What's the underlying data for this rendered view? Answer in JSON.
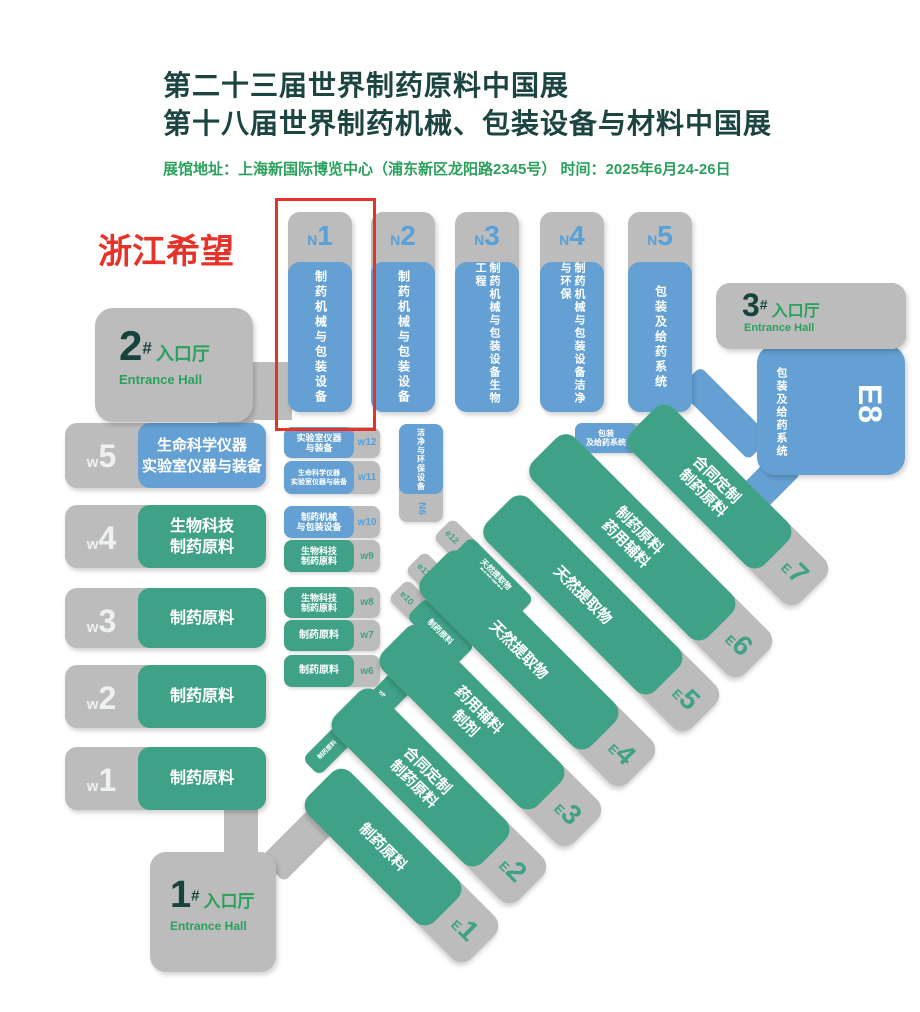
{
  "header": {
    "title_line1": "第二十三届世界制药原料中国展",
    "title_line2": "第十八届世界制药机械、包装设备与材料中国展",
    "info": "展馆地址：上海新国际博览中心（浦东新区龙阳路2345号）    时间：2025年6月24-26日"
  },
  "annotation": {
    "label": "浙江希望"
  },
  "entrances": {
    "no1": {
      "num": "1",
      "hash": "#",
      "cn": "入口厅",
      "en": "Entrance Hall"
    },
    "no2": {
      "num": "2",
      "hash": "#",
      "cn": "入口厅",
      "en": "Entrance Hall"
    },
    "no3": {
      "num": "3",
      "hash": "#",
      "cn": "入口厅",
      "en": "Entrance Hall"
    }
  },
  "n_halls": [
    {
      "prefix": "N",
      "num": "1",
      "lines": [
        "制药机械与包装设备",
        ""
      ]
    },
    {
      "prefix": "N",
      "num": "2",
      "lines": [
        "制药机械与包装设备",
        ""
      ]
    },
    {
      "prefix": "N",
      "num": "3",
      "lines": [
        "制药机械与包装设备",
        "生物工程"
      ]
    },
    {
      "prefix": "N",
      "num": "4",
      "lines": [
        "制药机械与包装设备",
        "洁净与环保"
      ]
    },
    {
      "prefix": "N",
      "num": "5",
      "lines": [
        "包装及给药系统",
        ""
      ]
    }
  ],
  "w_halls": [
    {
      "prefix": "w",
      "num": "5",
      "lines": [
        "生命科学仪器",
        "实验室仪器与装备"
      ]
    },
    {
      "prefix": "w",
      "num": "4",
      "lines": [
        "生物科技",
        "制药原料"
      ]
    },
    {
      "prefix": "w",
      "num": "3",
      "lines": [
        "制药原料",
        ""
      ]
    },
    {
      "prefix": "w",
      "num": "2",
      "lines": [
        "制药原料",
        ""
      ]
    },
    {
      "prefix": "w",
      "num": "1",
      "lines": [
        "制药原料",
        ""
      ]
    }
  ],
  "e_halls": [
    {
      "prefix": "E",
      "num": "1",
      "lines": [
        "制药原料",
        ""
      ]
    },
    {
      "prefix": "E",
      "num": "2",
      "lines": [
        "合同定制",
        "制药原料"
      ]
    },
    {
      "prefix": "E",
      "num": "3",
      "lines": [
        "药用辅料",
        "制剂"
      ]
    },
    {
      "prefix": "E",
      "num": "4",
      "lines": [
        "天然提取物",
        ""
      ]
    },
    {
      "prefix": "E",
      "num": "5",
      "lines": [
        "天然提取物",
        ""
      ]
    },
    {
      "prefix": "E",
      "num": "6",
      "lines": [
        "制药原料",
        "药用辅料"
      ]
    },
    {
      "prefix": "E",
      "num": "7",
      "lines": [
        "合同定制",
        "制药原料"
      ]
    }
  ],
  "e8_hall": {
    "label": "E8",
    "lines": [
      "包装及",
      "给药系统"
    ]
  },
  "mini_w": [
    {
      "label": "w12",
      "lines": [
        "实验室仪器",
        "与装备"
      ]
    },
    {
      "label": "w11",
      "lines": [
        "生命科学仪器",
        "实验室仪器与装备"
      ]
    },
    {
      "label": "w10",
      "lines": [
        "制药机械",
        "与包装设备"
      ]
    },
    {
      "label": "w9",
      "lines": [
        "生物科技",
        "制药原料"
      ]
    },
    {
      "label": "w8",
      "lines": [
        "生物科技",
        "制药原料"
      ]
    },
    {
      "label": "w7",
      "lines": [
        "制药原料",
        ""
      ]
    },
    {
      "label": "w6",
      "lines": [
        "制药原料",
        ""
      ]
    }
  ],
  "mini_n": [
    {
      "label": "N6",
      "lines": [
        "洁净与",
        "环保设备"
      ]
    },
    {
      "label": "N7",
      "lines": [
        "包装",
        "及给药系统"
      ]
    }
  ],
  "mini_e": [
    {
      "label": "e12",
      "lines": [
        "天然提取物",
        "制药原料"
      ]
    },
    {
      "label": "e11",
      "lines": [
        "制药原料",
        ""
      ]
    },
    {
      "label": "e10",
      "lines": [
        "制药原料",
        ""
      ]
    },
    {
      "label": "e9",
      "lines": [
        "制药原料",
        "制剂"
      ]
    },
    {
      "label": "e8",
      "lines": [
        "制药原料",
        ""
      ]
    }
  ],
  "colors": {
    "machinery_blue": "#64a0d3",
    "ingredients_green": "#3fa287",
    "hall_gray": "#bcbcbc",
    "title_dark": "#1c4441",
    "entrance_green": "#2aa05c",
    "annotation_red": "#e5332a"
  }
}
